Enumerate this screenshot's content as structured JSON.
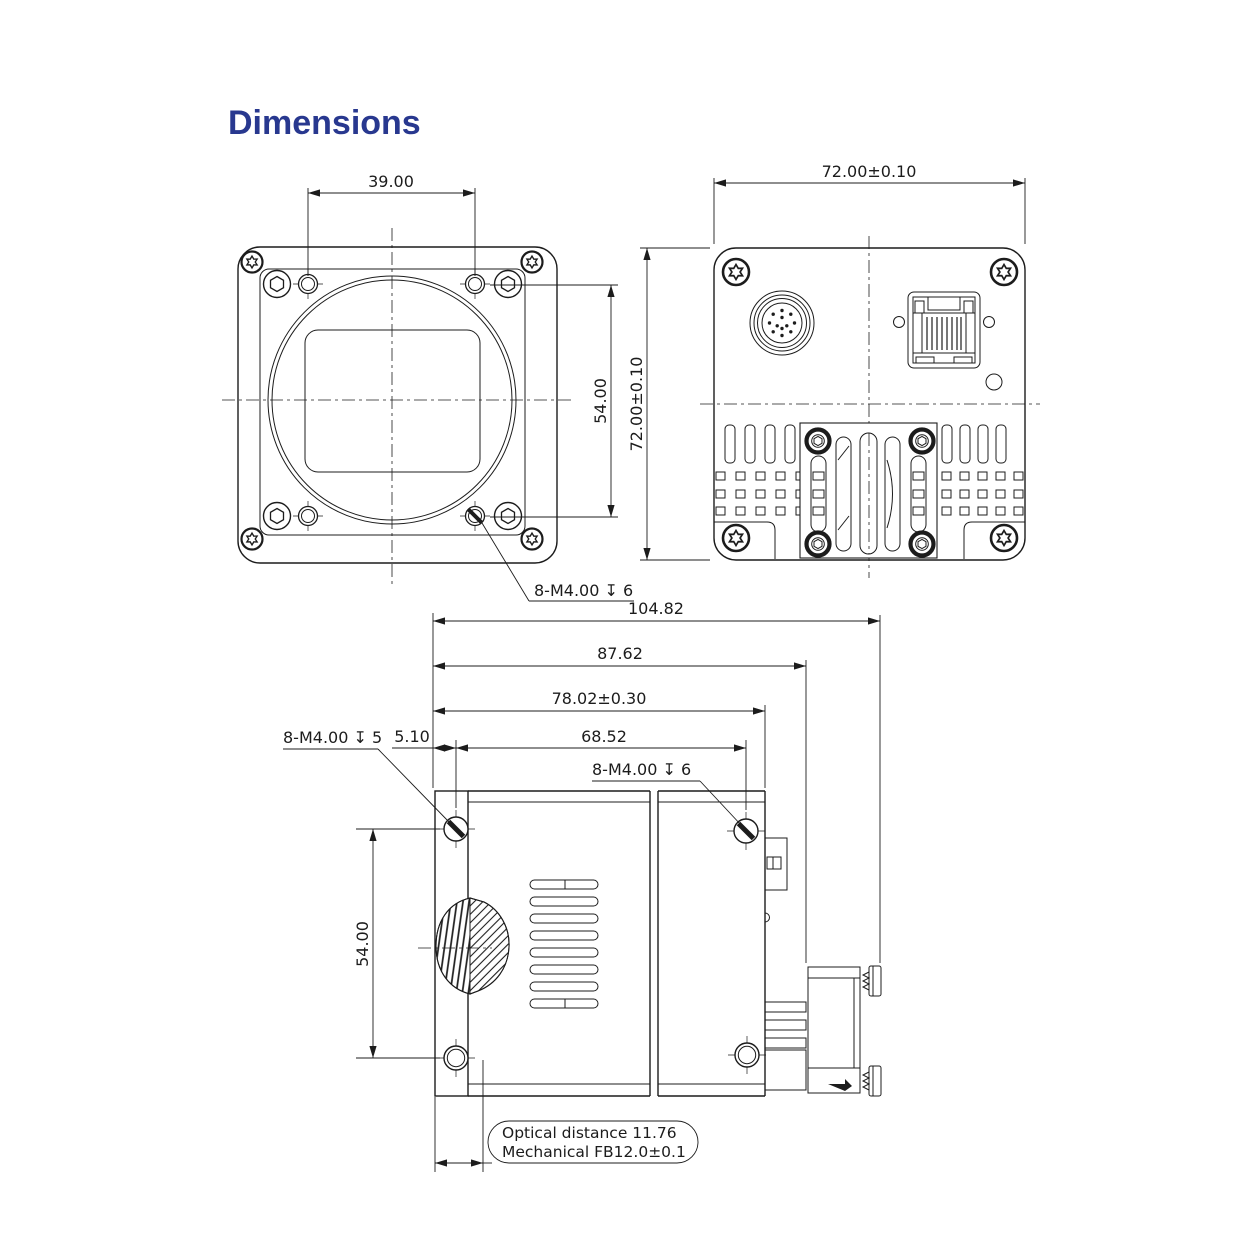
{
  "title": "Dimensions",
  "colors": {
    "title_accent": "#28388f",
    "line": "#1c1c1c"
  },
  "front_view": {
    "dim_width": "39.00",
    "dim_height": "54.00",
    "thread_note": "8-M4.00 ↧ 6"
  },
  "back_view": {
    "dim_width": "72.00±0.10",
    "dim_height": "72.00±0.10"
  },
  "side_view": {
    "dim_total": "104.82",
    "dim_to_connector": "87.62",
    "dim_body": "78.02±0.30",
    "dim_screws": "68.52",
    "dim_offset": "5.10",
    "dim_height": "54.00",
    "thread_note_front": "8-M4.00 ↧ 5",
    "thread_note_rear": "8-M4.00 ↧ 6",
    "optical_note_line1": "Optical distance 11.76",
    "optical_note_line2": "Mechanical FB12.0±0.1"
  }
}
